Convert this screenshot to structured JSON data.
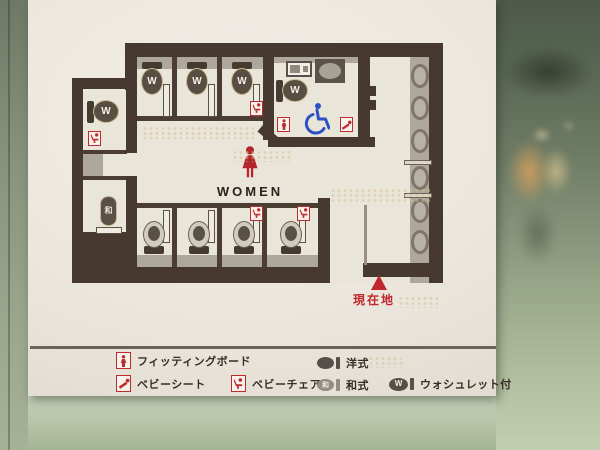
{
  "sign": {
    "plan": {
      "area_label": "WOMEN",
      "current_location_label": "現在地",
      "washlet_mark": "W",
      "japanese_style_mark": "和",
      "fixture_counts": {
        "washlet_toilets": 5,
        "western_toilets": 4,
        "japanese_toilets": 1,
        "wash_basins": 6,
        "accessible_stalls": 1,
        "baby_chair_marks": 4,
        "baby_sheet_marks": 1,
        "fitting_board_marks": 1
      }
    },
    "legend": {
      "items": [
        {
          "id": "fitting-board",
          "label": "フィッティングボード"
        },
        {
          "id": "baby-sheet",
          "label": "ベビーシート"
        },
        {
          "id": "baby-chair",
          "label": "ベビーチェア"
        },
        {
          "id": "western-style",
          "label": "洋式"
        },
        {
          "id": "japanese-style",
          "label": "和式",
          "mark": "和"
        },
        {
          "id": "washlet",
          "label": "ウォシュレット付",
          "mark": "W"
        }
      ]
    },
    "colors": {
      "wall_brown": "#473830",
      "accent_red": "#bf2a2e",
      "wheelchair_blue": "#2a50c4",
      "fixture_gray": "#aba49a",
      "sign_white": "#ede8df"
    }
  }
}
